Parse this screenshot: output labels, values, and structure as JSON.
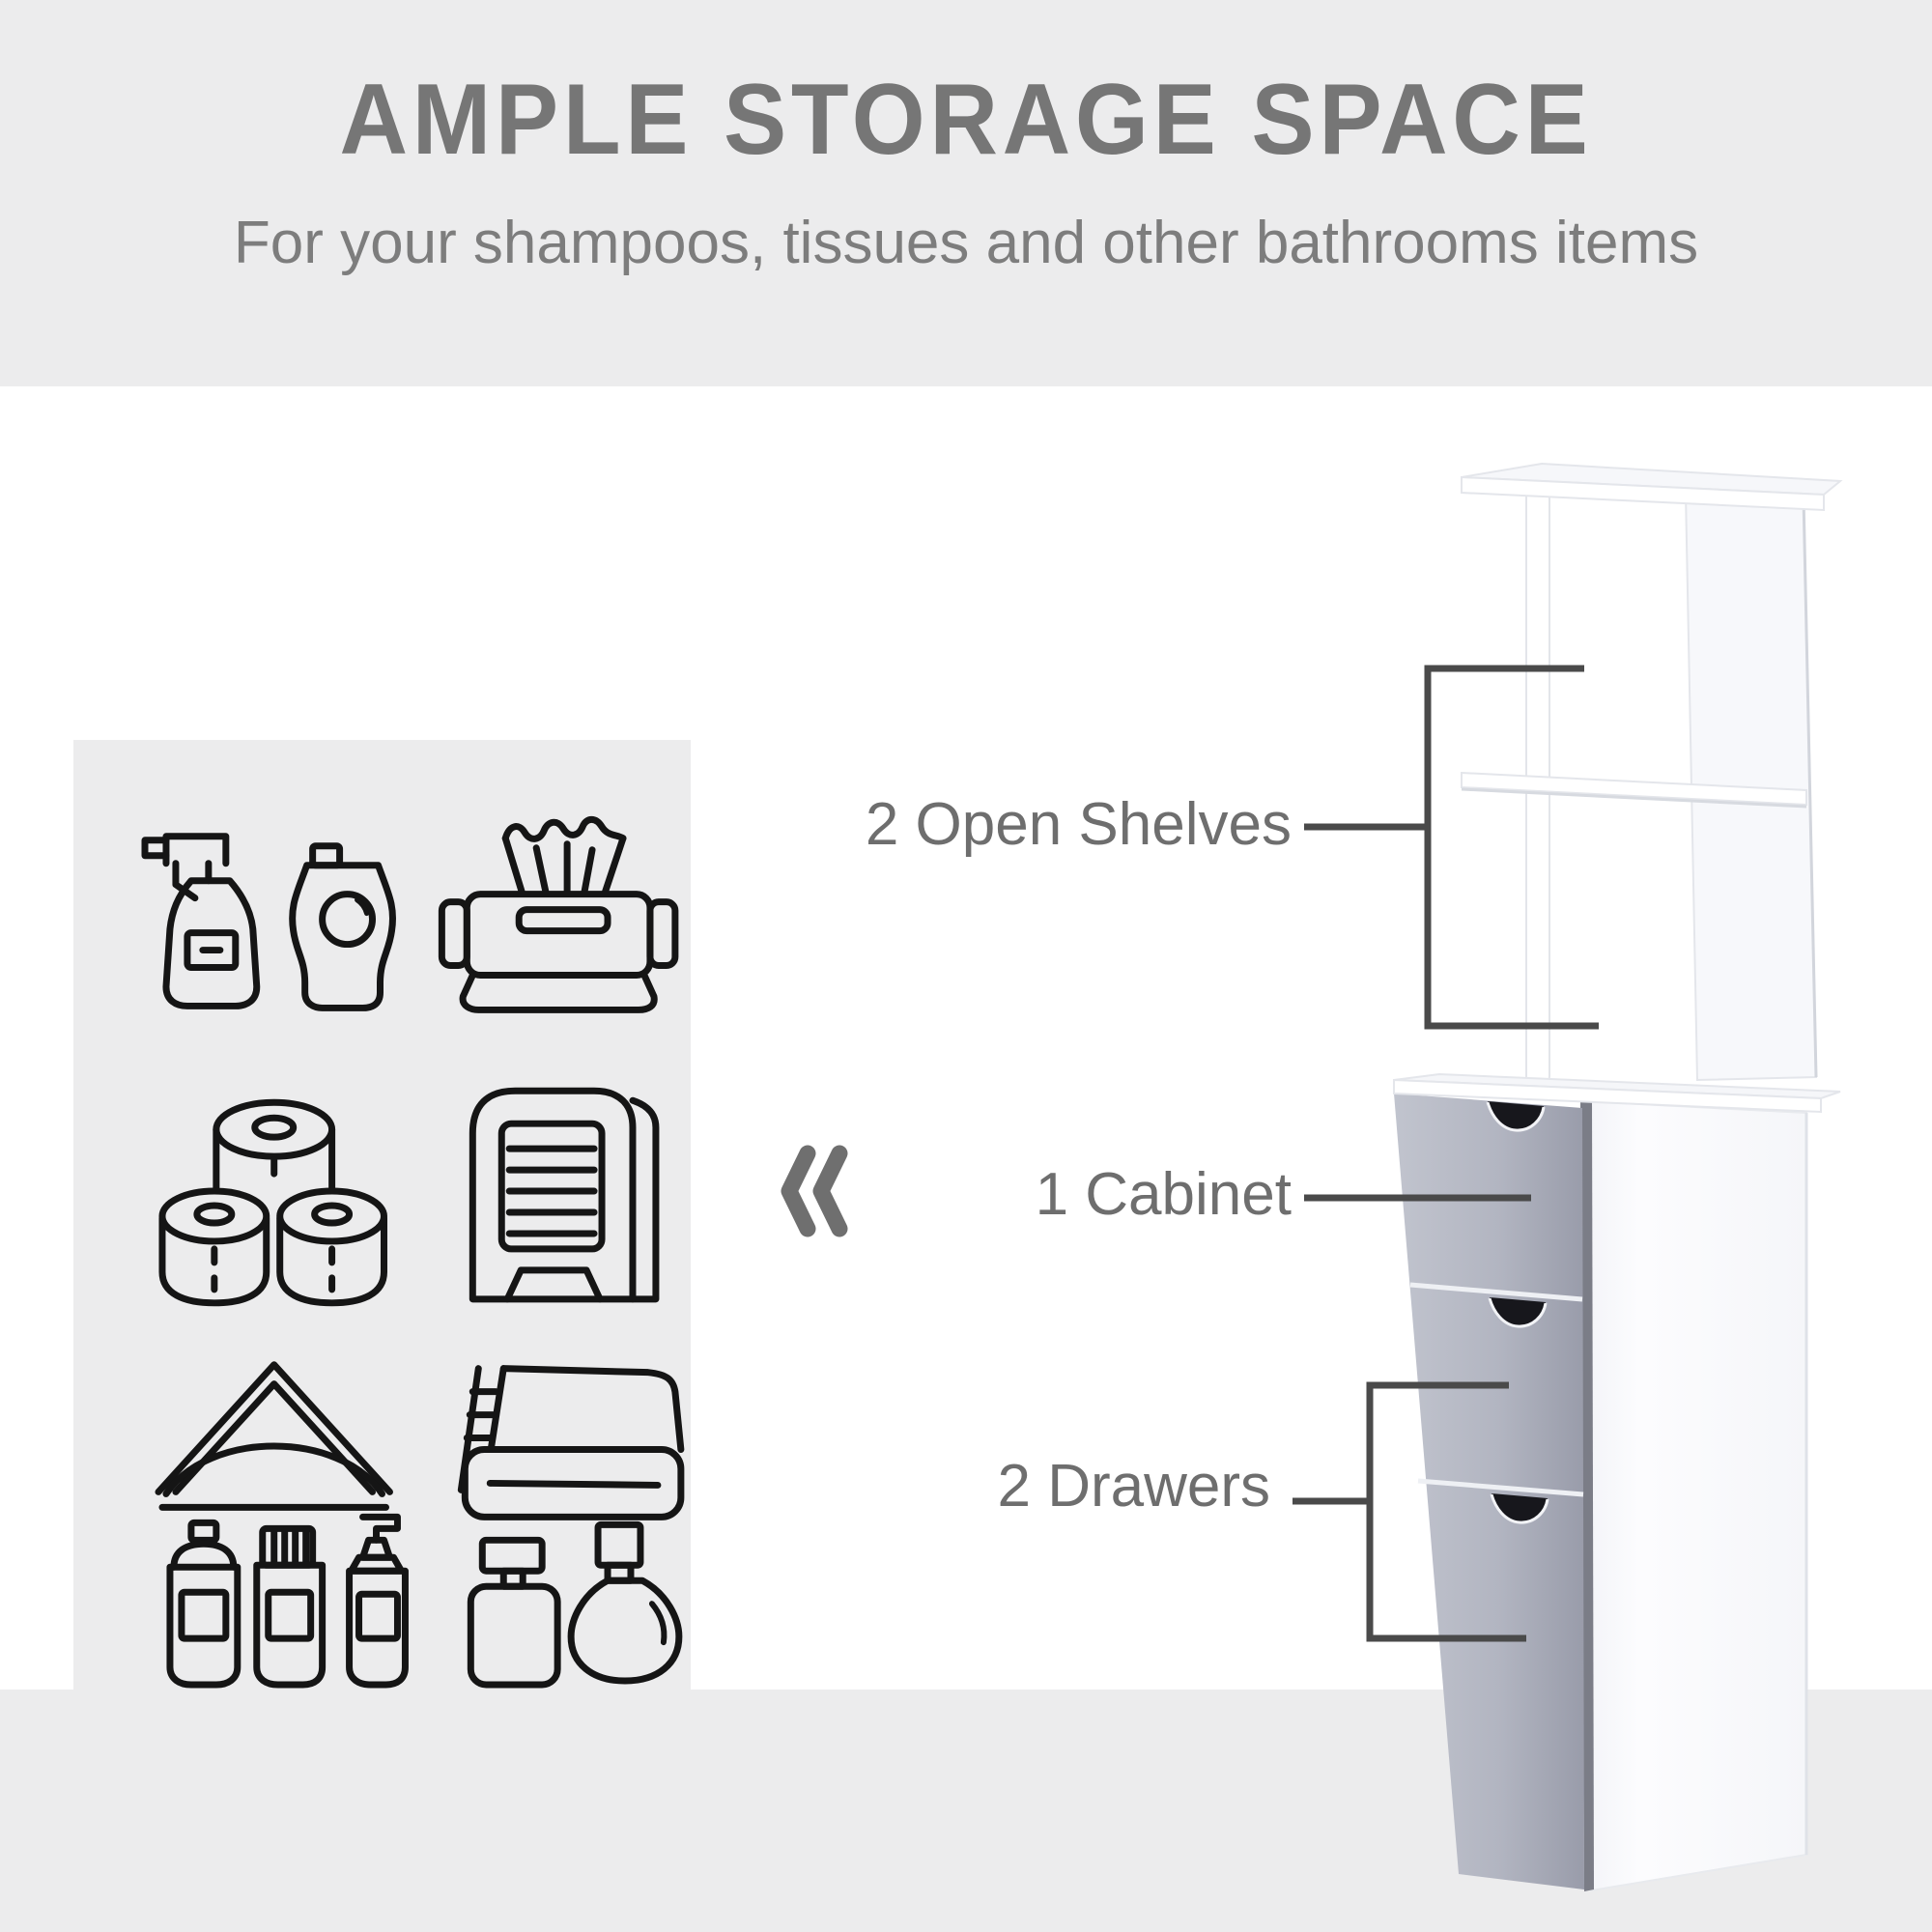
{
  "header": {
    "title": "AMPLE STORAGE SPACE",
    "subtitle": "For your shampoos, tissues and other bathrooms items"
  },
  "callouts": {
    "shelves": {
      "label": "2 Open Shelves"
    },
    "cabinet": {
      "label": "1 Cabinet"
    },
    "drawers": {
      "label": "2 Drawers"
    }
  },
  "icon_panel": {
    "icons": [
      "spray-and-soap-bottles",
      "wet-wipes-pack",
      "toilet-paper-rolls",
      "paper-towel-dispenser",
      "napkin-holder",
      "folded-towel",
      "toiletry-spray-bottles",
      "perfume-bottles"
    ]
  },
  "product": {
    "name": "bathroom-storage-tower",
    "features": [
      "2 Open Shelves",
      "1 Cabinet",
      "2 Drawers"
    ]
  },
  "colors": {
    "band_gray": "#ececed",
    "title_gray": "#767676",
    "label_gray": "#6e6e6e",
    "callout_line": "#4a4a4a",
    "icon_stroke": "#151515",
    "cabinet_front_gray": "#b0b3bf",
    "cabinet_edge_dark": "#7b7d87",
    "cabinet_white": "#ffffff"
  }
}
